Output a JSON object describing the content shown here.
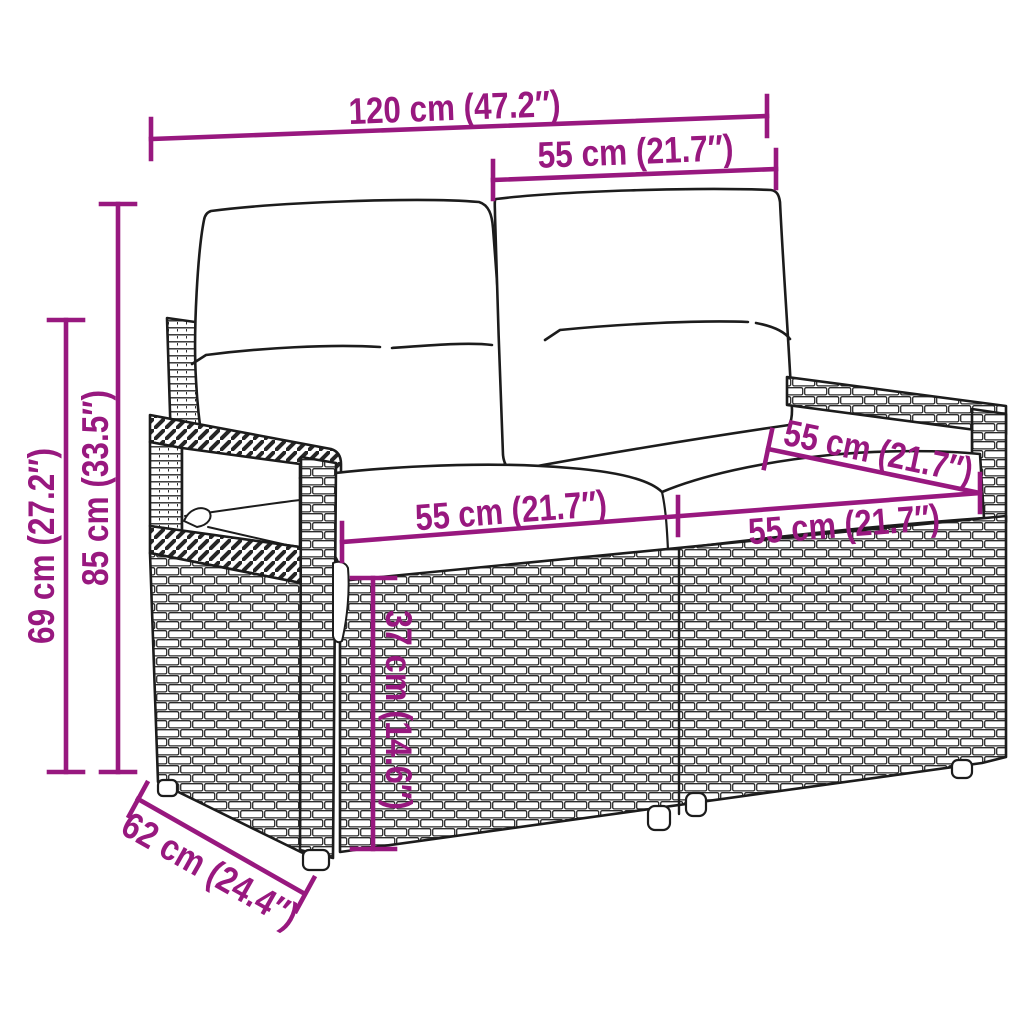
{
  "page": {
    "background": "#ffffff"
  },
  "accent_color": "#98187F",
  "figure": {
    "type": "product-dimension-diagram",
    "subject": "2-seater-rattan-garden-sofa-with-cushions"
  },
  "dimensions": {
    "total_width": {
      "label": "120 cm (47.2″)",
      "cm": 120,
      "inches": 47.2
    },
    "backrest_section_width": {
      "label": "55 cm (21.7″)",
      "cm": 55,
      "inches": 21.7
    },
    "total_height": {
      "label": "85 cm (33.5″)",
      "cm": 85,
      "inches": 33.5
    },
    "armrest_height": {
      "label": "69 cm (27.2″)",
      "cm": 69,
      "inches": 27.2
    },
    "seat_width_left": {
      "label": "55 cm (21.7″)",
      "cm": 55,
      "inches": 21.7
    },
    "seat_width_right": {
      "label": "55 cm (21.7″)",
      "cm": 55,
      "inches": 21.7
    },
    "seat_depth": {
      "label": "55 cm (21.7″)",
      "cm": 55,
      "inches": 21.7
    },
    "seat_height": {
      "label": "37 cm (14.6″)",
      "cm": 37,
      "inches": 14.6
    },
    "total_depth": {
      "label": "62 cm (24.4″)",
      "cm": 62,
      "inches": 24.4
    }
  }
}
